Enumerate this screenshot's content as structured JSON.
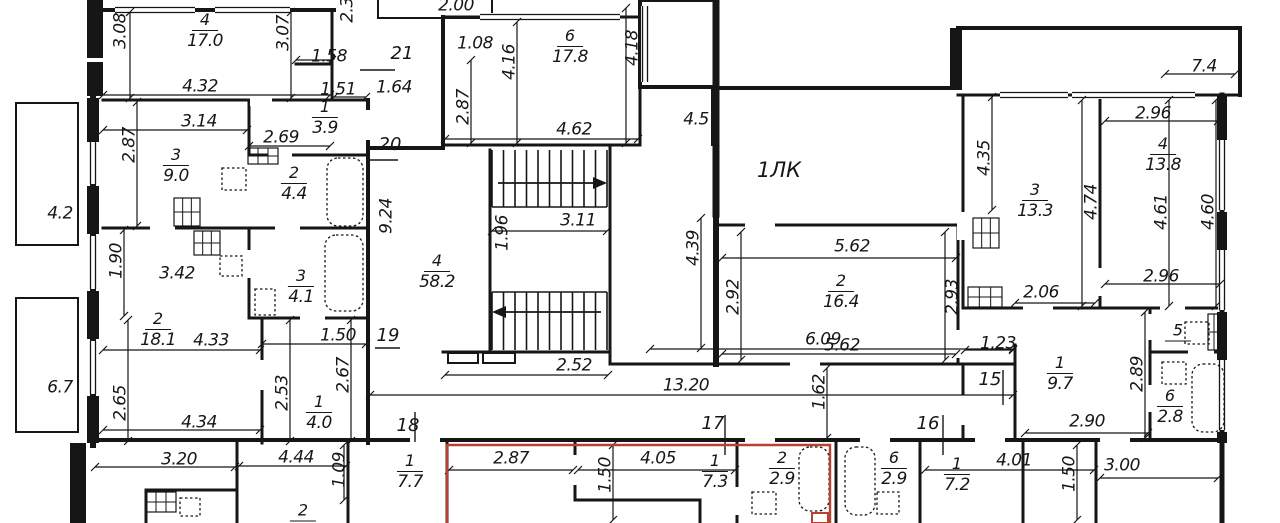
{
  "lobby": {
    "label": "1ЛК"
  },
  "colors": {
    "wall": "#161616",
    "highlight": "#b5432f",
    "background": "#ffffff"
  },
  "rooms": [
    {
      "num": "4",
      "area": "17.0",
      "x": 205,
      "y": 31
    },
    {
      "num": "1",
      "area": "3.9",
      "x": 325,
      "y": 118
    },
    {
      "num": "3",
      "area": "9.0",
      "x": 176,
      "y": 166
    },
    {
      "num": "2",
      "area": "4.4",
      "x": 294,
      "y": 184
    },
    {
      "num": "2",
      "area": "18.1",
      "x": 158,
      "y": 330
    },
    {
      "num": "3",
      "area": "4.1",
      "x": 301,
      "y": 287
    },
    {
      "num": "1",
      "area": "4.0",
      "x": 319,
      "y": 413
    },
    {
      "num": "6",
      "area": "17.8",
      "x": 570,
      "y": 47
    },
    {
      "num": "4",
      "area": "58.2",
      "x": 437,
      "y": 272
    },
    {
      "num": "3",
      "area": "13.3",
      "x": 1035,
      "y": 201
    },
    {
      "num": "4",
      "area": "13.8",
      "x": 1163,
      "y": 155
    },
    {
      "num": "2",
      "area": "16.4",
      "x": 841,
      "y": 292
    },
    {
      "num": "1",
      "area": "9.7",
      "x": 1060,
      "y": 374
    },
    {
      "num": "5",
      "area": "",
      "x": 1178,
      "y": 332
    },
    {
      "num": "6",
      "area": "2.8",
      "x": 1170,
      "y": 407
    },
    {
      "num": "1",
      "area": "7.7",
      "x": 410,
      "y": 472
    },
    {
      "num": "1",
      "area": "7.3",
      "x": 715,
      "y": 472
    },
    {
      "num": "2",
      "area": "2.9",
      "x": 782,
      "y": 469
    },
    {
      "num": "6",
      "area": "2.9",
      "x": 894,
      "y": 469
    },
    {
      "num": "1",
      "area": "7.2",
      "x": 957,
      "y": 475
    },
    {
      "num": "2",
      "area": "",
      "x": 303,
      "y": 512
    }
  ],
  "dimensions": [
    {
      "t": "3.08",
      "x": 121,
      "y": 31,
      "r": -90
    },
    {
      "t": "3.07",
      "x": 284,
      "y": 33,
      "r": -90
    },
    {
      "t": "2.3",
      "x": 348,
      "y": 10,
      "r": -90
    },
    {
      "t": "1.58",
      "x": 329,
      "y": 57,
      "r": 0
    },
    {
      "t": "4.32",
      "x": 200,
      "y": 87,
      "r": 0
    },
    {
      "t": "1.51",
      "x": 338,
      "y": 90,
      "r": 0
    },
    {
      "t": "3.14",
      "x": 199,
      "y": 122,
      "r": 0
    },
    {
      "t": "2.69",
      "x": 281,
      "y": 138,
      "r": 0
    },
    {
      "t": "2.87",
      "x": 130,
      "y": 145,
      "r": -90
    },
    {
      "t": "4.2",
      "x": 60,
      "y": 214,
      "r": 0
    },
    {
      "t": "1.90",
      "x": 117,
      "y": 261,
      "r": -90
    },
    {
      "t": "3.42",
      "x": 177,
      "y": 274,
      "r": 0
    },
    {
      "t": "4.33",
      "x": 211,
      "y": 341,
      "r": 0
    },
    {
      "t": "1.50",
      "x": 338,
      "y": 336,
      "r": 0
    },
    {
      "t": "2.67",
      "x": 344,
      "y": 375,
      "r": -90
    },
    {
      "t": "2.53",
      "x": 283,
      "y": 393,
      "r": -90
    },
    {
      "t": "6.7",
      "x": 60,
      "y": 388,
      "r": 0
    },
    {
      "t": "2.65",
      "x": 121,
      "y": 403,
      "r": -90
    },
    {
      "t": "4.34",
      "x": 199,
      "y": 423,
      "r": 0
    },
    {
      "t": "1.64",
      "x": 394,
      "y": 88,
      "r": 0
    },
    {
      "t": "9.24",
      "x": 387,
      "y": 216,
      "r": -90
    },
    {
      "t": "2.00",
      "x": 456,
      "y": 6,
      "r": 0
    },
    {
      "t": "1.08",
      "x": 475,
      "y": 44,
      "r": 0
    },
    {
      "t": "4.16",
      "x": 510,
      "y": 62,
      "r": -90
    },
    {
      "t": "4.18",
      "x": 633,
      "y": 48,
      "r": -90
    },
    {
      "t": "2.87",
      "x": 464,
      "y": 107,
      "r": -90
    },
    {
      "t": "4.62",
      "x": 574,
      "y": 130,
      "r": 0
    },
    {
      "t": "4.5",
      "x": 696,
      "y": 120,
      "r": 0
    },
    {
      "t": "1.96",
      "x": 503,
      "y": 233,
      "r": -90
    },
    {
      "t": "3.11",
      "x": 578,
      "y": 221,
      "r": 0
    },
    {
      "t": "2.52",
      "x": 574,
      "y": 366,
      "r": 0
    },
    {
      "t": "6.09",
      "x": 823,
      "y": 340,
      "r": 0
    },
    {
      "t": "13.20",
      "x": 686,
      "y": 386,
      "r": 0
    },
    {
      "t": "1.62",
      "x": 820,
      "y": 392,
      "r": -90
    },
    {
      "t": "4.39",
      "x": 694,
      "y": 248,
      "r": -90
    },
    {
      "t": "7.4",
      "x": 1204,
      "y": 67,
      "r": 0
    },
    {
      "t": "2.96",
      "x": 1153,
      "y": 114,
      "r": 0
    },
    {
      "t": "4.35",
      "x": 985,
      "y": 158,
      "r": -90
    },
    {
      "t": "4.74",
      "x": 1092,
      "y": 202,
      "r": -90
    },
    {
      "t": "4.61",
      "x": 1162,
      "y": 212,
      "r": -90
    },
    {
      "t": "4.60",
      "x": 1209,
      "y": 212,
      "r": -90
    },
    {
      "t": "5.62",
      "x": 852,
      "y": 247,
      "r": 0
    },
    {
      "t": "2.92",
      "x": 734,
      "y": 297,
      "r": -90
    },
    {
      "t": "2.93",
      "x": 953,
      "y": 297,
      "r": -90
    },
    {
      "t": "5.62",
      "x": 842,
      "y": 346,
      "r": 0
    },
    {
      "t": "2.06",
      "x": 1041,
      "y": 293,
      "r": 0
    },
    {
      "t": "2.96",
      "x": 1161,
      "y": 277,
      "r": 0
    },
    {
      "t": "1.23",
      "x": 998,
      "y": 344,
      "r": 0
    },
    {
      "t": "2.89",
      "x": 1138,
      "y": 374,
      "r": -90
    },
    {
      "t": "2.90",
      "x": 1087,
      "y": 422,
      "r": 0
    },
    {
      "t": "3.20",
      "x": 179,
      "y": 460,
      "r": 0
    },
    {
      "t": "4.44",
      "x": 296,
      "y": 458,
      "r": 0
    },
    {
      "t": "1.09",
      "x": 340,
      "y": 470,
      "r": -90
    },
    {
      "t": "2.87",
      "x": 511,
      "y": 459,
      "r": 0
    },
    {
      "t": "1.50",
      "x": 606,
      "y": 475,
      "r": -90
    },
    {
      "t": "4.05",
      "x": 658,
      "y": 459,
      "r": 0
    },
    {
      "t": "4.01",
      "x": 1014,
      "y": 461,
      "r": 0
    },
    {
      "t": "1.50",
      "x": 1070,
      "y": 474,
      "r": -90
    },
    {
      "t": "3.00",
      "x": 1122,
      "y": 466,
      "r": 0
    }
  ],
  "grid_marks": [
    {
      "t": "21",
      "x": 402,
      "y": 54
    },
    {
      "t": "20",
      "x": 390,
      "y": 145
    },
    {
      "t": "19",
      "x": 388,
      "y": 336
    },
    {
      "t": "18",
      "x": 408,
      "y": 426
    },
    {
      "t": "17",
      "x": 713,
      "y": 424
    },
    {
      "t": "16",
      "x": 928,
      "y": 424
    },
    {
      "t": "15",
      "x": 990,
      "y": 380
    }
  ]
}
